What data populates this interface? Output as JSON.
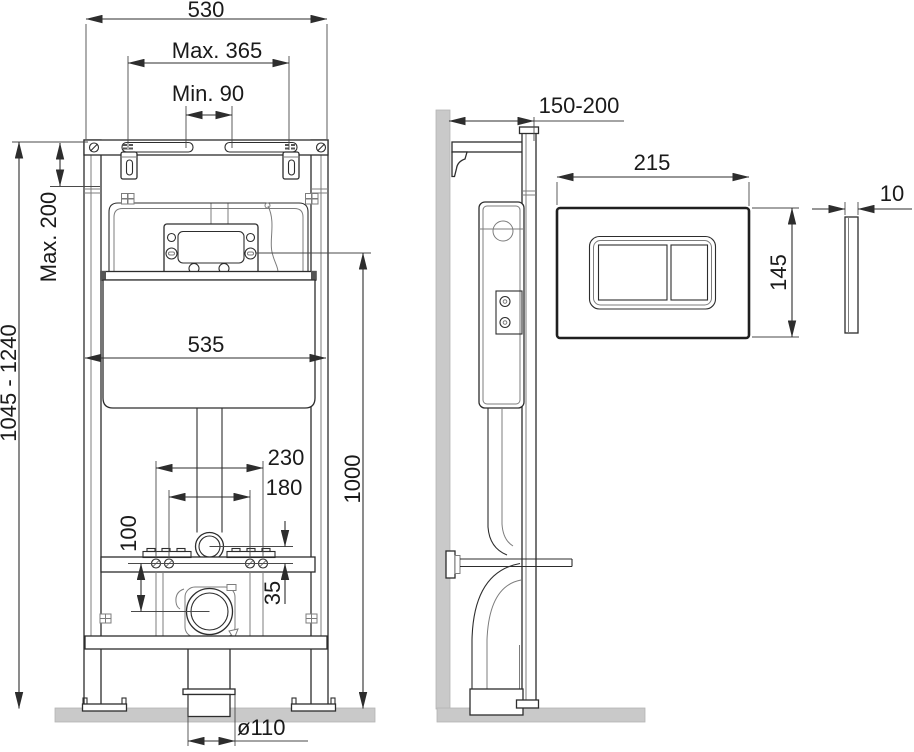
{
  "colors": {
    "line": "#2d2d2d",
    "line_light": "#7c7c7c",
    "surface": "#c9c9c9",
    "text": "#1a1a1a"
  },
  "dimensions": {
    "frame_width": "530",
    "bracket_spacing_max": "Max. 365",
    "bracket_spacing_min": "Min. 90",
    "install_height_range": "1045 - 1240",
    "top_extension_max": "Max. 200",
    "cistern_width": "535",
    "fixing_outer_spacing": "230",
    "fixing_inner_spacing": "180",
    "rail_to_outlet": "100",
    "pipe_to_rail": "35",
    "panel_center_height": "1000",
    "outlet_diameter": "ø110",
    "wall_offset_range": "150-200",
    "plate_width": "215",
    "plate_height": "145",
    "plate_thickness": "10"
  }
}
